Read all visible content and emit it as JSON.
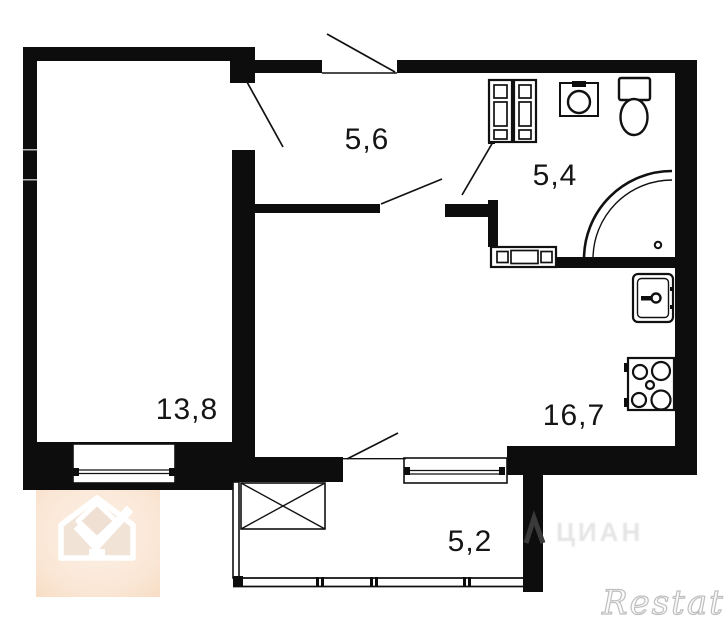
{
  "plan": {
    "title": "apartment-floor-plan",
    "rooms": [
      {
        "name": "hallway",
        "area": "5,6"
      },
      {
        "name": "bathroom",
        "area": "5,4"
      },
      {
        "name": "room",
        "area": "13,8"
      },
      {
        "name": "kitchen-living-room",
        "area": "16,7"
      },
      {
        "name": "balcony",
        "area": "5,2"
      }
    ],
    "fixtures": [
      "wardrobe-cabinets",
      "bathroom-sink",
      "toilet",
      "corner-shower",
      "washing-machine",
      "kitchen-sink",
      "stove",
      "balcony-crossed-box",
      "windows",
      "door-swings"
    ],
    "colors": {
      "wall": "#0d0d0d",
      "logo_peach": "#f8dfc8",
      "watermark_gray": "#bfbfbf"
    }
  },
  "watermarks": {
    "brand": "Restate",
    "center_text": "ЦИАН"
  }
}
